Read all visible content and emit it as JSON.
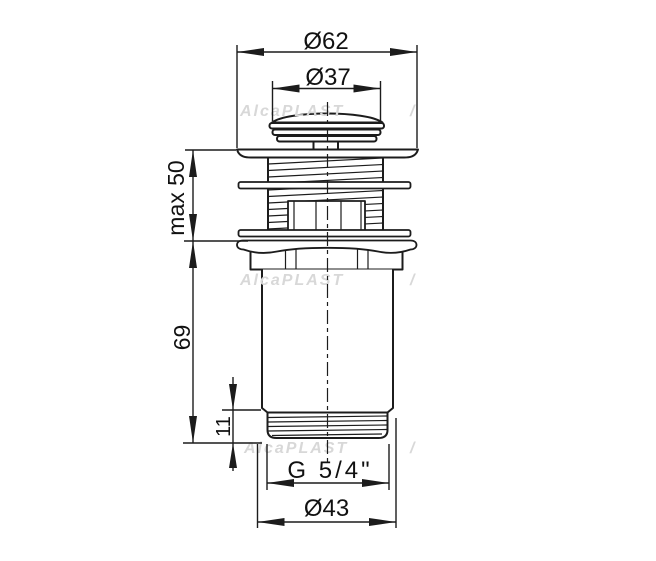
{
  "watermark": {
    "text": "AlcaPLAST",
    "fragment": "/",
    "color": "#d8d8d8"
  },
  "dimensions": {
    "d62": {
      "label": "Ø62"
    },
    "d37": {
      "label": "Ø37"
    },
    "max50": {
      "label": "max 50"
    },
    "h69": {
      "label": "69"
    },
    "h11": {
      "label": "11"
    },
    "thread": {
      "label": "G 5/4\""
    },
    "d43": {
      "label": "Ø43"
    }
  },
  "colors": {
    "line": "#1c1c1c",
    "background": "#ffffff",
    "watermark": "#d8d8d8"
  }
}
